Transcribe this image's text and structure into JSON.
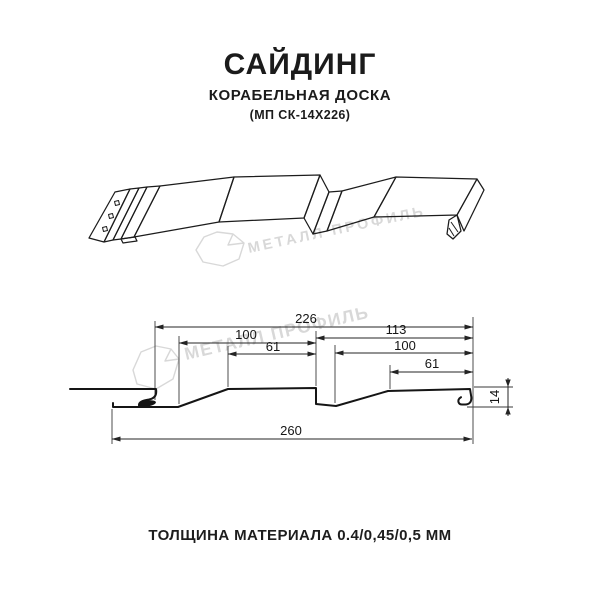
{
  "header": {
    "title": "САЙДИНГ",
    "subtitle": "КОРАБЕЛЬНАЯ ДОСКА",
    "model": "(МП СК-14Х226)"
  },
  "watermark": {
    "brand": "МЕТАЛЛ ПРОФИЛЬ",
    "color": "#d8d8d8"
  },
  "section_dimensions": {
    "total_cover_width": "226",
    "left_plank_width": "100",
    "left_plank_top_flat": "61",
    "right_segment_width": "113",
    "right_plank_width": "100",
    "right_plank_top_flat": "61",
    "profile_height": "14",
    "overall_width": "260"
  },
  "footer": {
    "thickness_note": "ТОЛЩИНА МАТЕРИАЛА 0.4/0,45/0,5 ММ"
  }
}
